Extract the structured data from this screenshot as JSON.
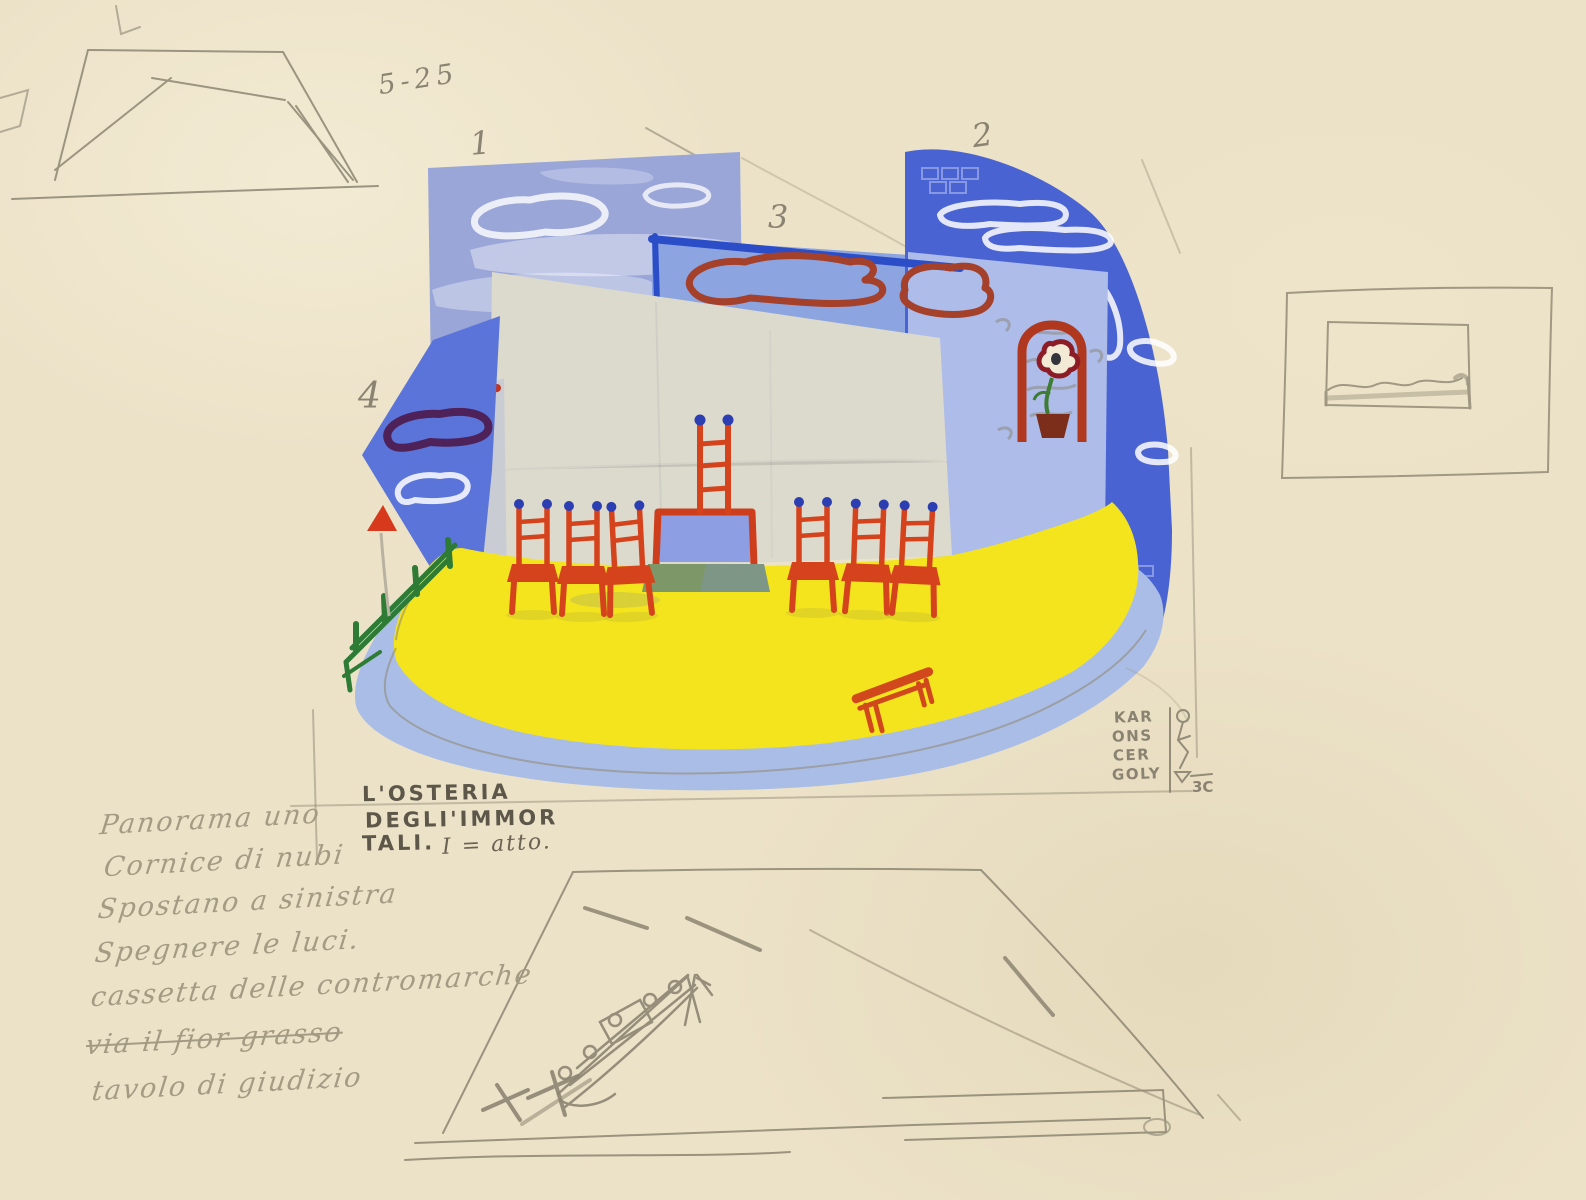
{
  "artwork": {
    "inscription_top": "5-25",
    "panel_numbers": [
      "1",
      "2",
      "3",
      "4"
    ],
    "title": {
      "line1": "L'OSTERIA",
      "line2": "DEGLI'IMMOR",
      "line3": "TALI.",
      "act": "I = atto."
    },
    "signature": [
      "KAR",
      "ONS",
      "CER",
      "GOLY"
    ],
    "signature_mark": "3C",
    "notes": [
      {
        "text": "Panorama uno"
      },
      {
        "text": "Cornice di nubi"
      },
      {
        "text": "Spostano a sinistra"
      },
      {
        "text": "Spegnere le luci."
      },
      {
        "text": "cassetta delle contromarche"
      },
      {
        "text": "via il fior grasso"
      },
      {
        "text": "tavolo di giudizio"
      }
    ],
    "colors": {
      "paper": "#ece2c8",
      "pencil": "#8a8371",
      "panel1_lavender": "#9aa6d8",
      "panel2_blue": "#4a63d2",
      "panel3_blue": "#8ca4e0",
      "panel3_border": "#2b4ec8",
      "panel4_blue": "#5b74da",
      "niche_wall": "#adbce8",
      "screen_gray": "#dcdacd",
      "floor_yellow": "#f4e41d",
      "apron_blue": "#aabde6",
      "chair_red": "#d5431c",
      "frame_red": "#b0381f",
      "cloud_brown": "#a5402a",
      "cloud_purple": "#4e2158",
      "fence_green": "#2d7b35",
      "step_green": "#7e9768",
      "table_front": "#8d9fe2",
      "finial_blue": "#2b3eb2"
    }
  }
}
